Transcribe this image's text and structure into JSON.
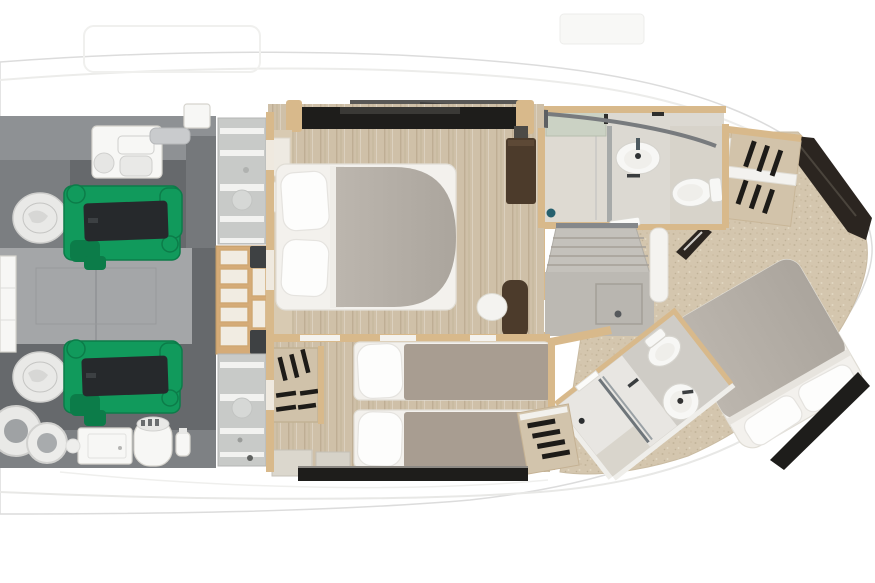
{
  "colors": {
    "hull_line": "#dcdcdc",
    "engine_room_floor": "#66696c",
    "engine_room_platform": "#a4a6a8",
    "engine_green": "#119a5c",
    "engine_green_dark": "#0c7c49",
    "engine_black": "#26292c",
    "bulkhead_panel": "#c8cac8",
    "bulkhead_stripe": "#f2f2f0",
    "wood_trim": "#d8b98b",
    "shelf_cell": "#f1ece2",
    "floor_wood": "#cfc0a8",
    "floor_wood_dark": "#bfae94",
    "aft_floor": "#d4c6ae",
    "carpet_gray": "#bcb9b3",
    "duvet_gray": "#b4aea6",
    "duvet_taupe": "#a89d91",
    "pillow_white": "#fdfdfc",
    "window_black": "#1e1d1b",
    "window_brown": "#2b2520",
    "bath_floor": "#dcd9d2",
    "bath_floor_greige": "#cfccc6",
    "fixture_white": "#f7f7f5",
    "fixture_line": "#d6d4ce",
    "teal_accent": "#26606e",
    "cabinet_brown": "#4c3b2b",
    "greenish_cabinet": "#cbd2c4"
  },
  "scene": {
    "type": "yacht-lower-deck-floor-plan",
    "orientation": "bow-right",
    "rooms": [
      {
        "id": "engine-room",
        "side": "left",
        "items": [
          "green-engine-port",
          "green-engine-starboard",
          "generator-box",
          "pod-drive-port",
          "pod-drive-starboard",
          "ring-tank",
          "ring-tank",
          "equipment-box",
          "water-heater-cylinder"
        ]
      },
      {
        "id": "bulkhead-lockers",
        "side": "left-center",
        "items": [
          "striped-locker-top",
          "wood-shelf-steps",
          "striped-locker-bottom"
        ]
      },
      {
        "id": "forward-vip-cabin",
        "side": "center-top",
        "items": [
          "double-bed",
          "pillow",
          "pillow",
          "gray-duvet",
          "tall-brown-cabinet",
          "brown-vanity-seat",
          "white-stool",
          "hull-window-strip"
        ]
      },
      {
        "id": "guest-twin-cabin",
        "side": "center-bottom",
        "items": [
          "single-bed",
          "single-bed",
          "hanging-wardrobe",
          "hanging-locker",
          "storage-boxes",
          "hull-window-strip"
        ]
      },
      {
        "id": "forward-head",
        "side": "top-right-of-center",
        "items": [
          "shower",
          "glass-divider",
          "round-washbasin",
          "toilet",
          "drain"
        ]
      },
      {
        "id": "master-cabin",
        "side": "right",
        "items": [
          "double-bed",
          "pillow",
          "pillow",
          "hanging-wardrobe",
          "hull-window-band",
          "hull-window-strip"
        ]
      },
      {
        "id": "master-head",
        "side": "bottom-right",
        "items": [
          "shower",
          "glass-divider",
          "round-washbasin",
          "toilet"
        ]
      },
      {
        "id": "stair-landing",
        "side": "center",
        "items": [
          "staircase-up",
          "floor-hatch",
          "curved-wall"
        ]
      }
    ]
  }
}
